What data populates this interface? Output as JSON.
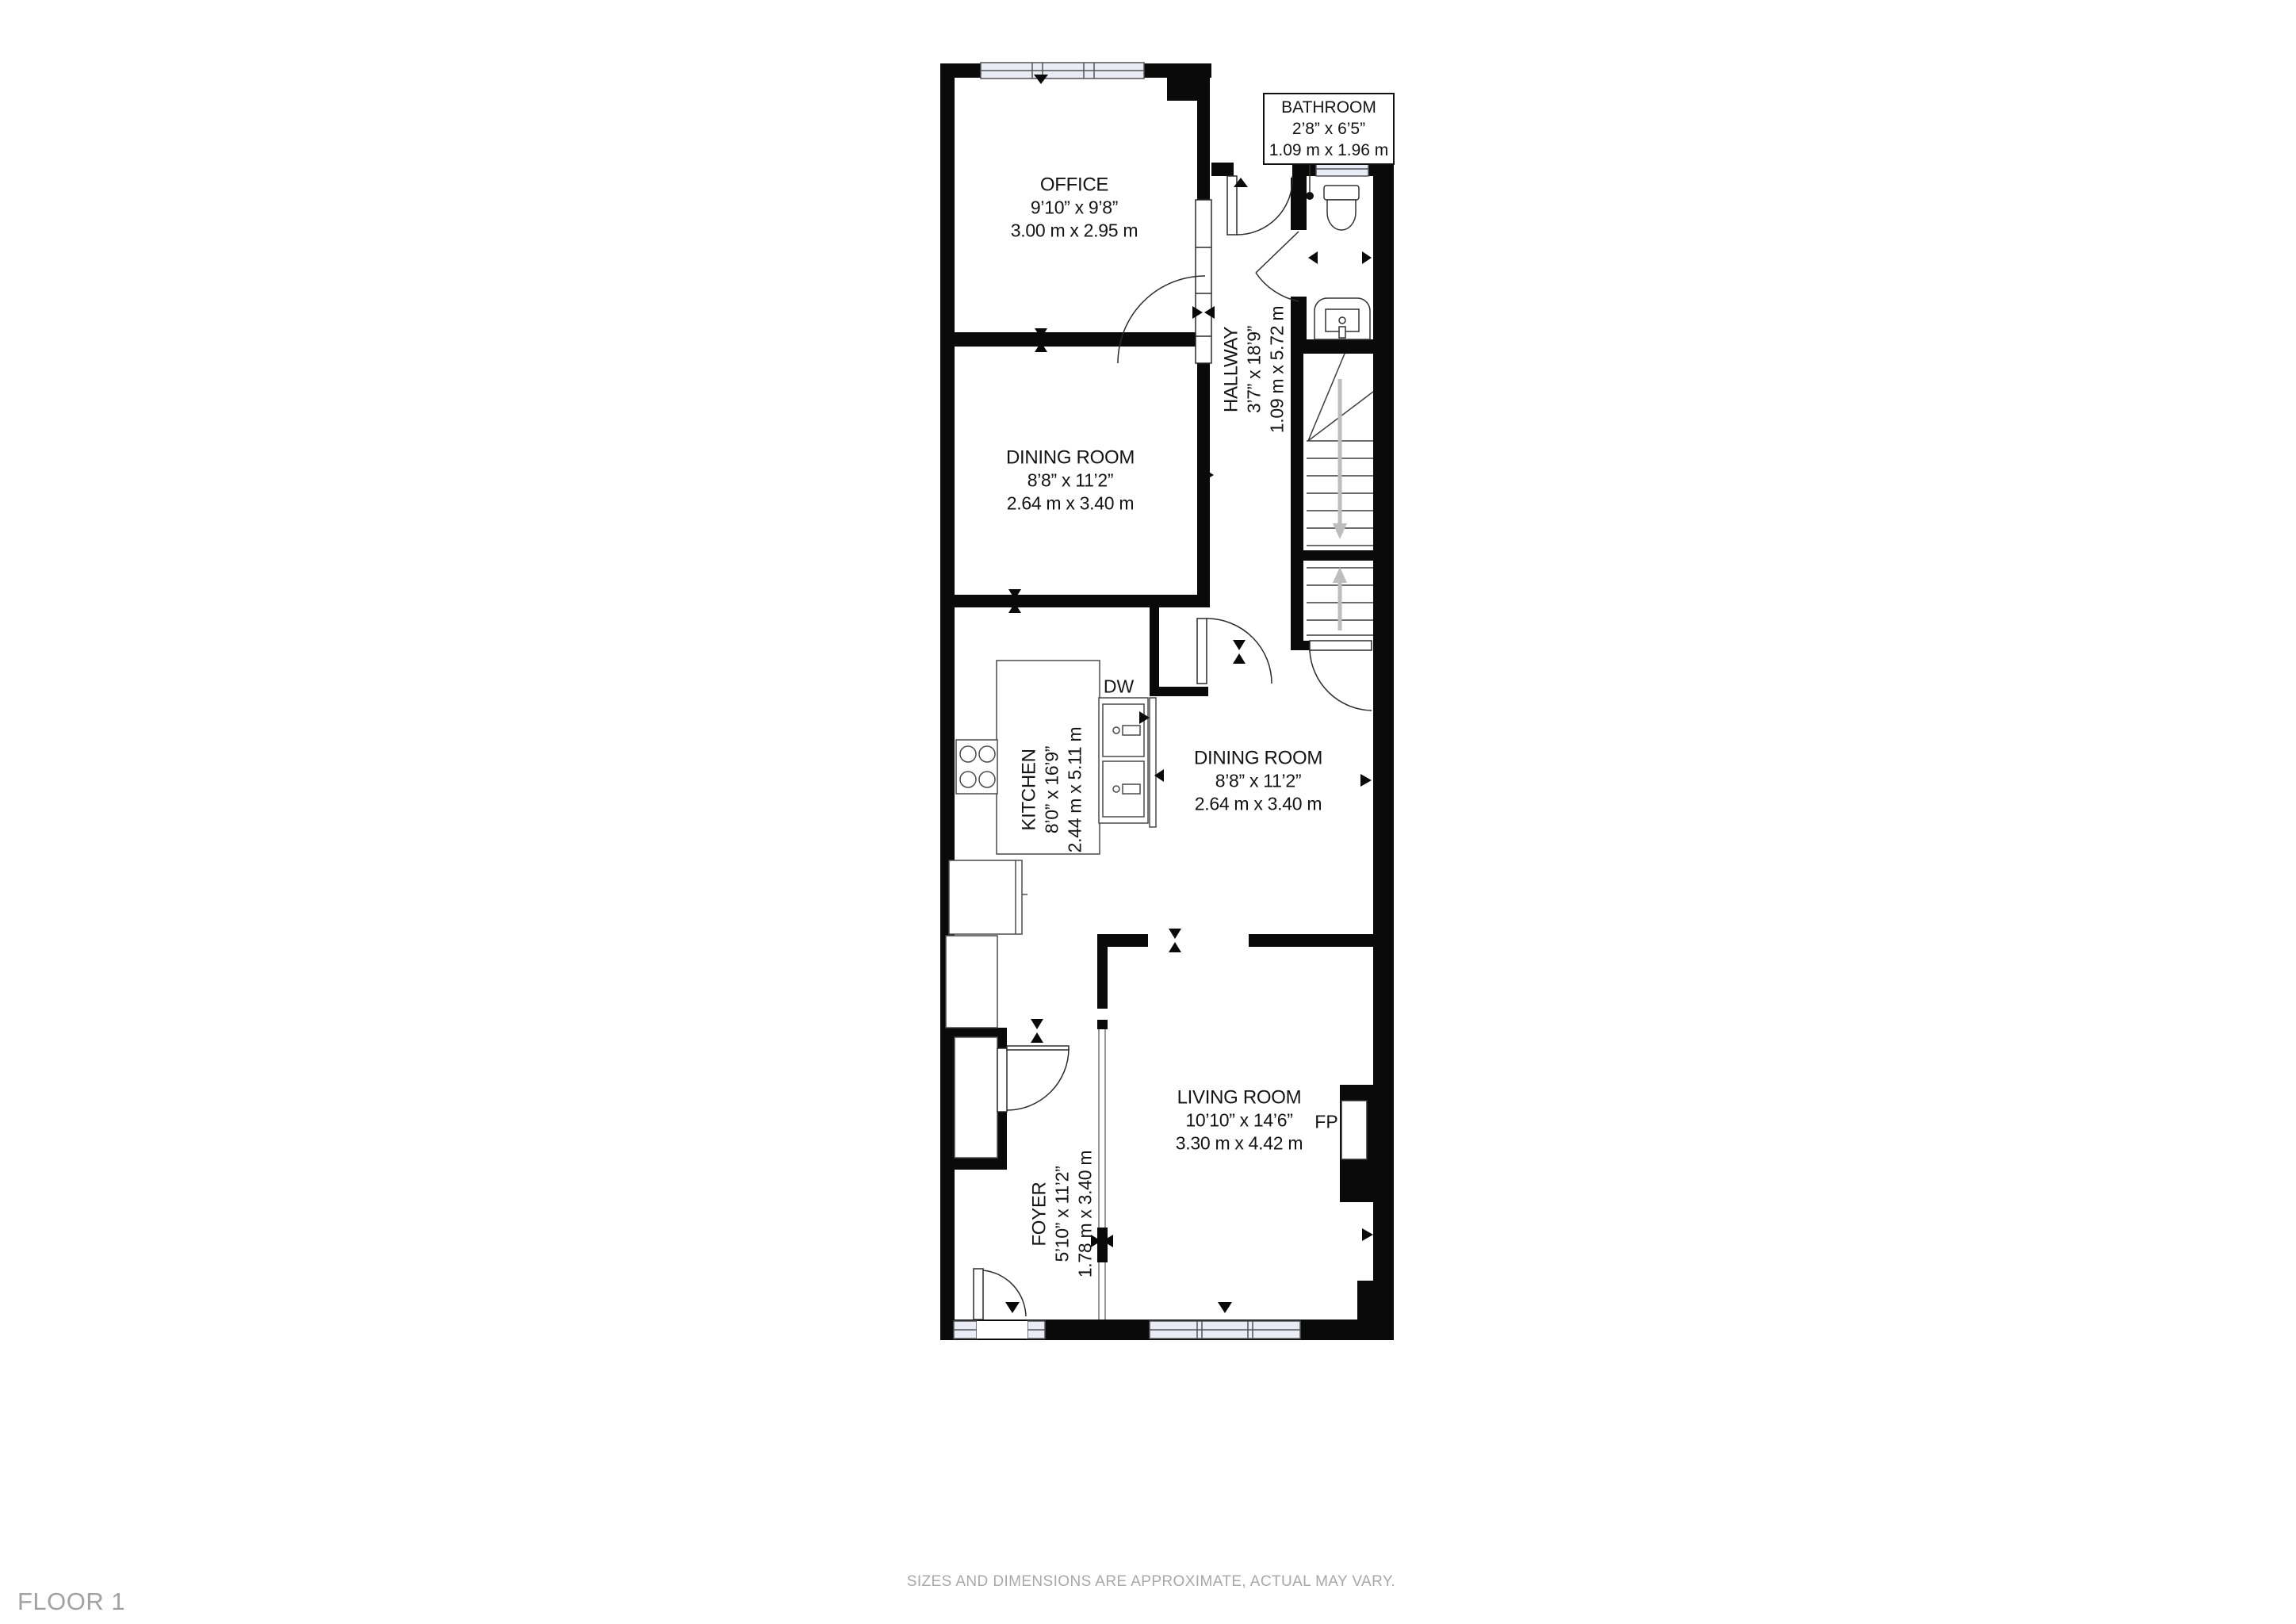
{
  "floor_label": "FLOOR 1",
  "disclaimer": "SIZES AND DIMENSIONS ARE APPROXIMATE, ACTUAL MAY VARY.",
  "rooms": {
    "office": {
      "name": "OFFICE",
      "imperial": "9’10” x 9’8”",
      "metric": "3.00 m x 2.95 m"
    },
    "dining_room_1": {
      "name": "DINING ROOM",
      "imperial": "8’8” x 11’2”",
      "metric": "2.64 m x 3.40 m"
    },
    "dining_room_2": {
      "name": "DINING ROOM",
      "imperial": "8’8” x 11’2”",
      "metric": "2.64 m x 3.40 m"
    },
    "kitchen": {
      "name": "KITCHEN",
      "imperial": "8’0” x 16’9”",
      "metric": "2.44 m x 5.11 m"
    },
    "hallway": {
      "name": "HALLWAY",
      "imperial": "3’7” x 18’9”",
      "metric": "1.09 m x 5.72 m"
    },
    "bathroom": {
      "name": "BATHROOM",
      "imperial": "2’8” x 6’5”",
      "metric": "1.09 m x 1.96 m"
    },
    "living_room": {
      "name": "LIVING ROOM",
      "imperial": "10’10” x 14’6”",
      "metric": "3.30 m x 4.42 m"
    },
    "foyer": {
      "name": "FOYER",
      "imperial": "5’10” x 11’2”",
      "metric": "1.78 m x 3.40 m"
    }
  },
  "fixtures": {
    "dishwasher": "DW",
    "fireplace": "FP"
  },
  "colors": {
    "wall": "#0a0a0a",
    "window_fill": "#e9ebf7",
    "label": "#141414",
    "muted": "#a8a8a8",
    "stair_arrow": "#bdbdbd"
  }
}
